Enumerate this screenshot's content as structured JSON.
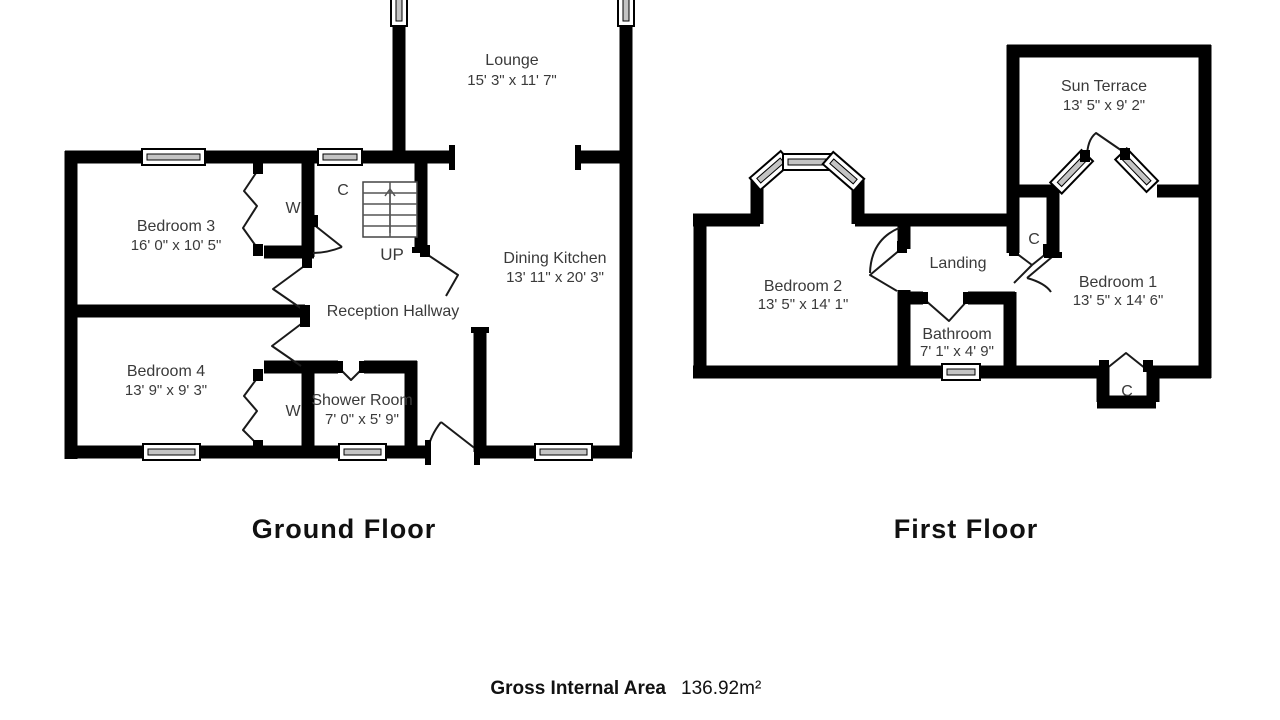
{
  "ground_floor": {
    "title": "Ground Floor",
    "rooms": {
      "lounge": {
        "name": "Lounge",
        "dims": "15' 3\" x 11' 7\""
      },
      "bedroom3": {
        "name": "Bedroom 3",
        "dims": "16' 0\" x 10' 5\""
      },
      "dining_kitchen": {
        "name": "Dining Kitchen",
        "dims": "13' 11\" x 20' 3\""
      },
      "reception_hallway": {
        "name": "Reception Hallway"
      },
      "bedroom4": {
        "name": "Bedroom 4",
        "dims": "13' 9\" x 9' 3\""
      },
      "shower_room": {
        "name": "Shower Room",
        "dims": "7' 0\" x 5' 9\""
      }
    },
    "markers": {
      "cupboard": "C",
      "wardrobe_bedroom3": "W",
      "wardrobe_bedroom4": "W",
      "stairs_up": "UP"
    }
  },
  "first_floor": {
    "title": "First Floor",
    "rooms": {
      "sun_terrace": {
        "name": "Sun Terrace",
        "dims": "13' 5\" x 9' 2\""
      },
      "bedroom2": {
        "name": "Bedroom 2",
        "dims": "13' 5\" x 14' 1\""
      },
      "landing": {
        "name": "Landing"
      },
      "bathroom": {
        "name": "Bathroom",
        "dims": "7' 1\" x 4' 9\""
      },
      "bedroom1": {
        "name": "Bedroom 1",
        "dims": "13' 5\" x 14' 6\""
      }
    },
    "markers": {
      "cupboard_landing": "C",
      "cupboard_bedroom1": "C"
    }
  },
  "footer": {
    "label": "Gross Internal Area",
    "value": "136.92m²"
  },
  "colors": {
    "wall": "#000000",
    "room_text": "#3a3a3a",
    "title_text": "#111111"
  }
}
